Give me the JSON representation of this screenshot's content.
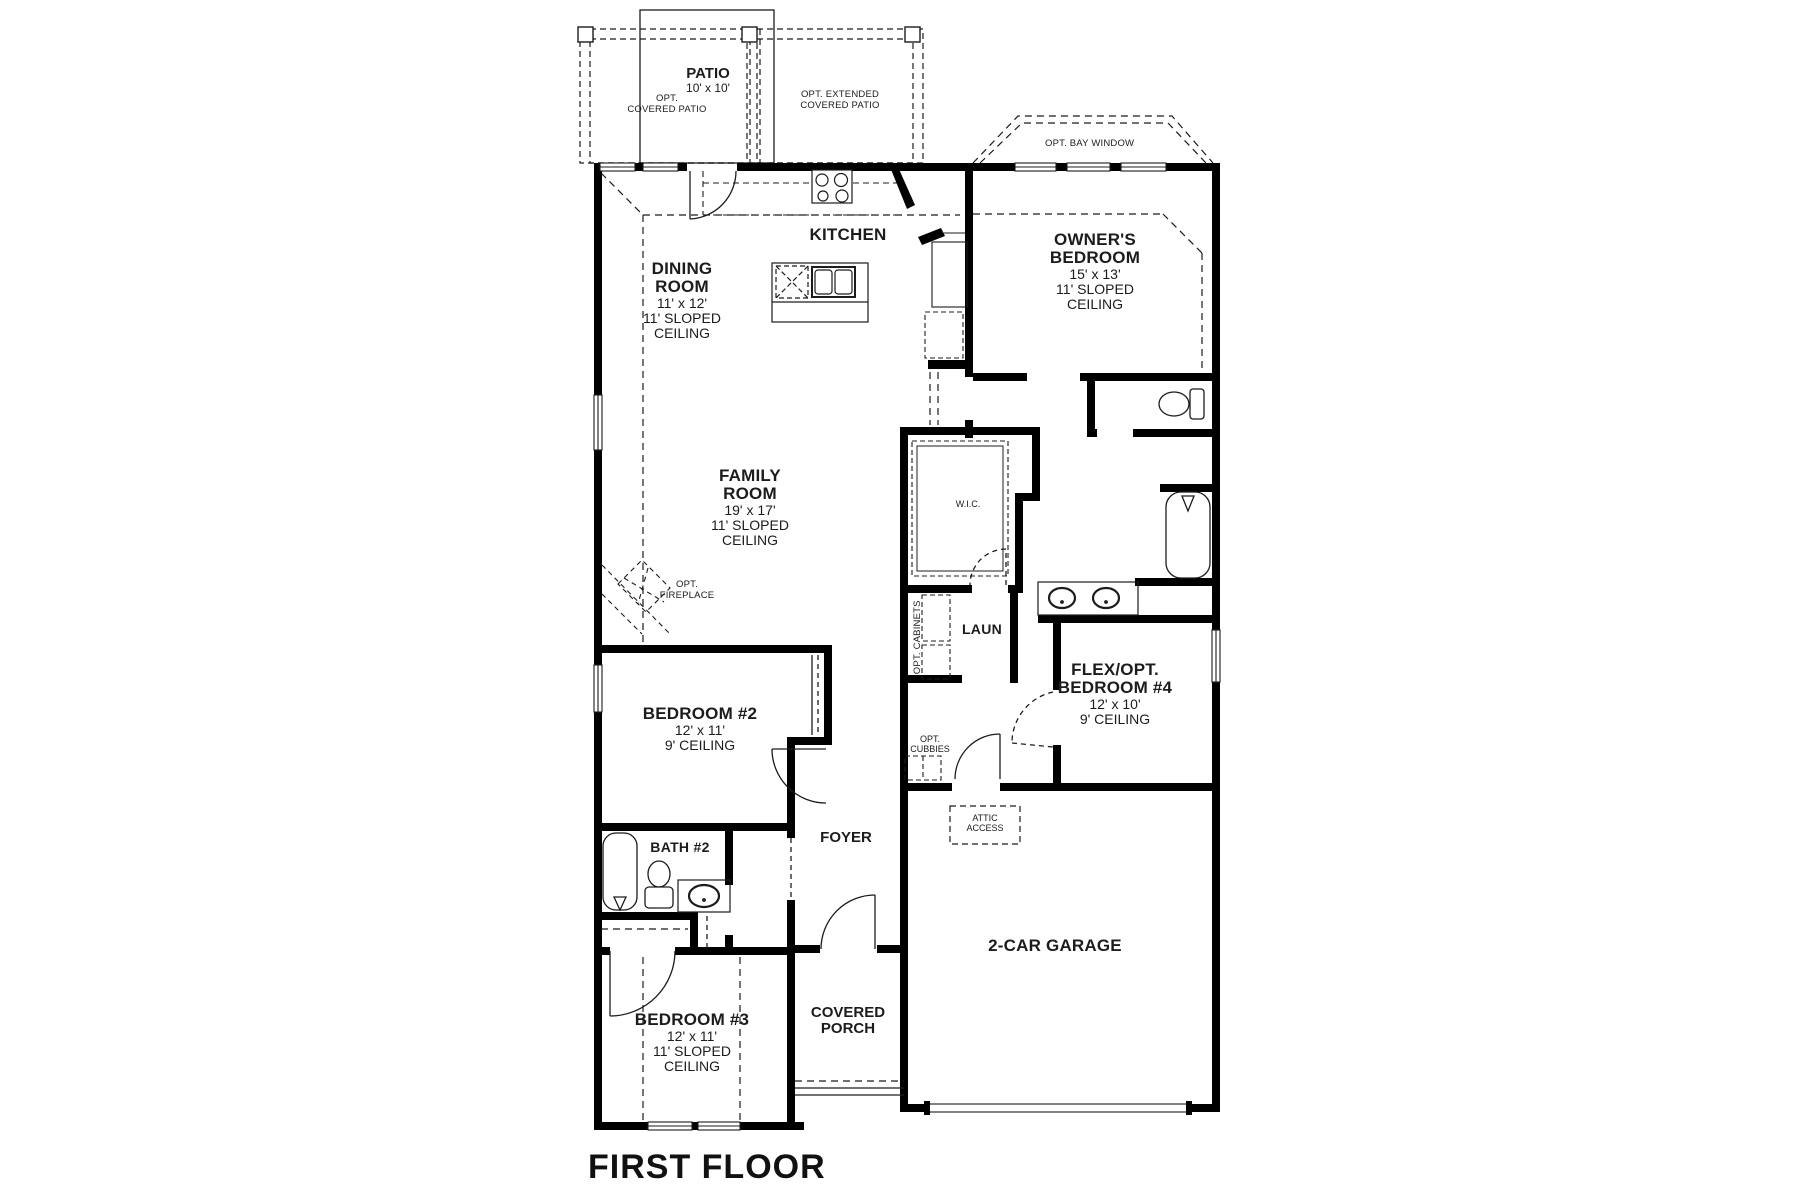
{
  "page_title": "FIRST FLOOR",
  "rooms": {
    "dining": {
      "name": "DINING ROOM",
      "size": "11' x 12'",
      "ceiling": "11' SLOPED CEILING"
    },
    "kitchen": {
      "name": "KITCHEN"
    },
    "owners_bedroom": {
      "name": "OWNER'S BEDROOM",
      "size": "15' x 13'",
      "ceiling": "11' SLOPED CEILING"
    },
    "family": {
      "name": "FAMILY ROOM",
      "size": "19' x 17'",
      "ceiling": "11' SLOPED CEILING"
    },
    "wic": {
      "name": "W.I.C."
    },
    "laundry": {
      "name": "LAUN"
    },
    "bedroom4": {
      "name": "FLEX/OPT. BEDROOM #4",
      "size": "12' x 10'",
      "ceiling": "9' CEILING"
    },
    "bedroom2": {
      "name": "BEDROOM #2",
      "size": "12' x 11'",
      "ceiling": "9' CEILING"
    },
    "bath2": {
      "name": "BATH #2"
    },
    "foyer": {
      "name": "FOYER"
    },
    "garage": {
      "name": "2-CAR GARAGE"
    },
    "bedroom3": {
      "name": "BEDROOM #3",
      "size": "12' x 11'",
      "ceiling": "11' SLOPED CEILING"
    },
    "porch": {
      "name": "COVERED PORCH"
    }
  },
  "annotations": {
    "patio": {
      "name": "PATIO",
      "size": "10' x 10'"
    },
    "opt_covered_patio": {
      "lines": [
        "OPT.",
        "COVERED PATIO"
      ]
    },
    "opt_extended_patio": {
      "lines": [
        "OPT. EXTENDED",
        "COVERED PATIO"
      ]
    },
    "opt_bay_window": {
      "lines": [
        "OPT. BAY WINDOW"
      ]
    },
    "opt_fireplace": {
      "lines": [
        "OPT.",
        "FIREPLACE"
      ]
    },
    "opt_cabinets": {
      "lines": [
        "OPT. CABINETS"
      ]
    },
    "opt_cubbies": {
      "lines": [
        "OPT.",
        "CUBBIES"
      ]
    },
    "attic_access": {
      "lines": [
        "ATTIC",
        "ACCESS"
      ]
    }
  },
  "fixtures": [
    "cooktop",
    "island-sink",
    "dishwasher",
    "refrigerator",
    "pantry",
    "washer-dryer-cabinets",
    "owners-toilet",
    "owners-bathtub",
    "owners-double-vanity",
    "wic-shelves",
    "bath2-tub",
    "bath2-toilet",
    "bath2-sink",
    "mud-cubbies",
    "attic-access-panel"
  ],
  "colors": {
    "wall": "#000000",
    "line": "#1c1c1c",
    "background": "#ffffff"
  }
}
